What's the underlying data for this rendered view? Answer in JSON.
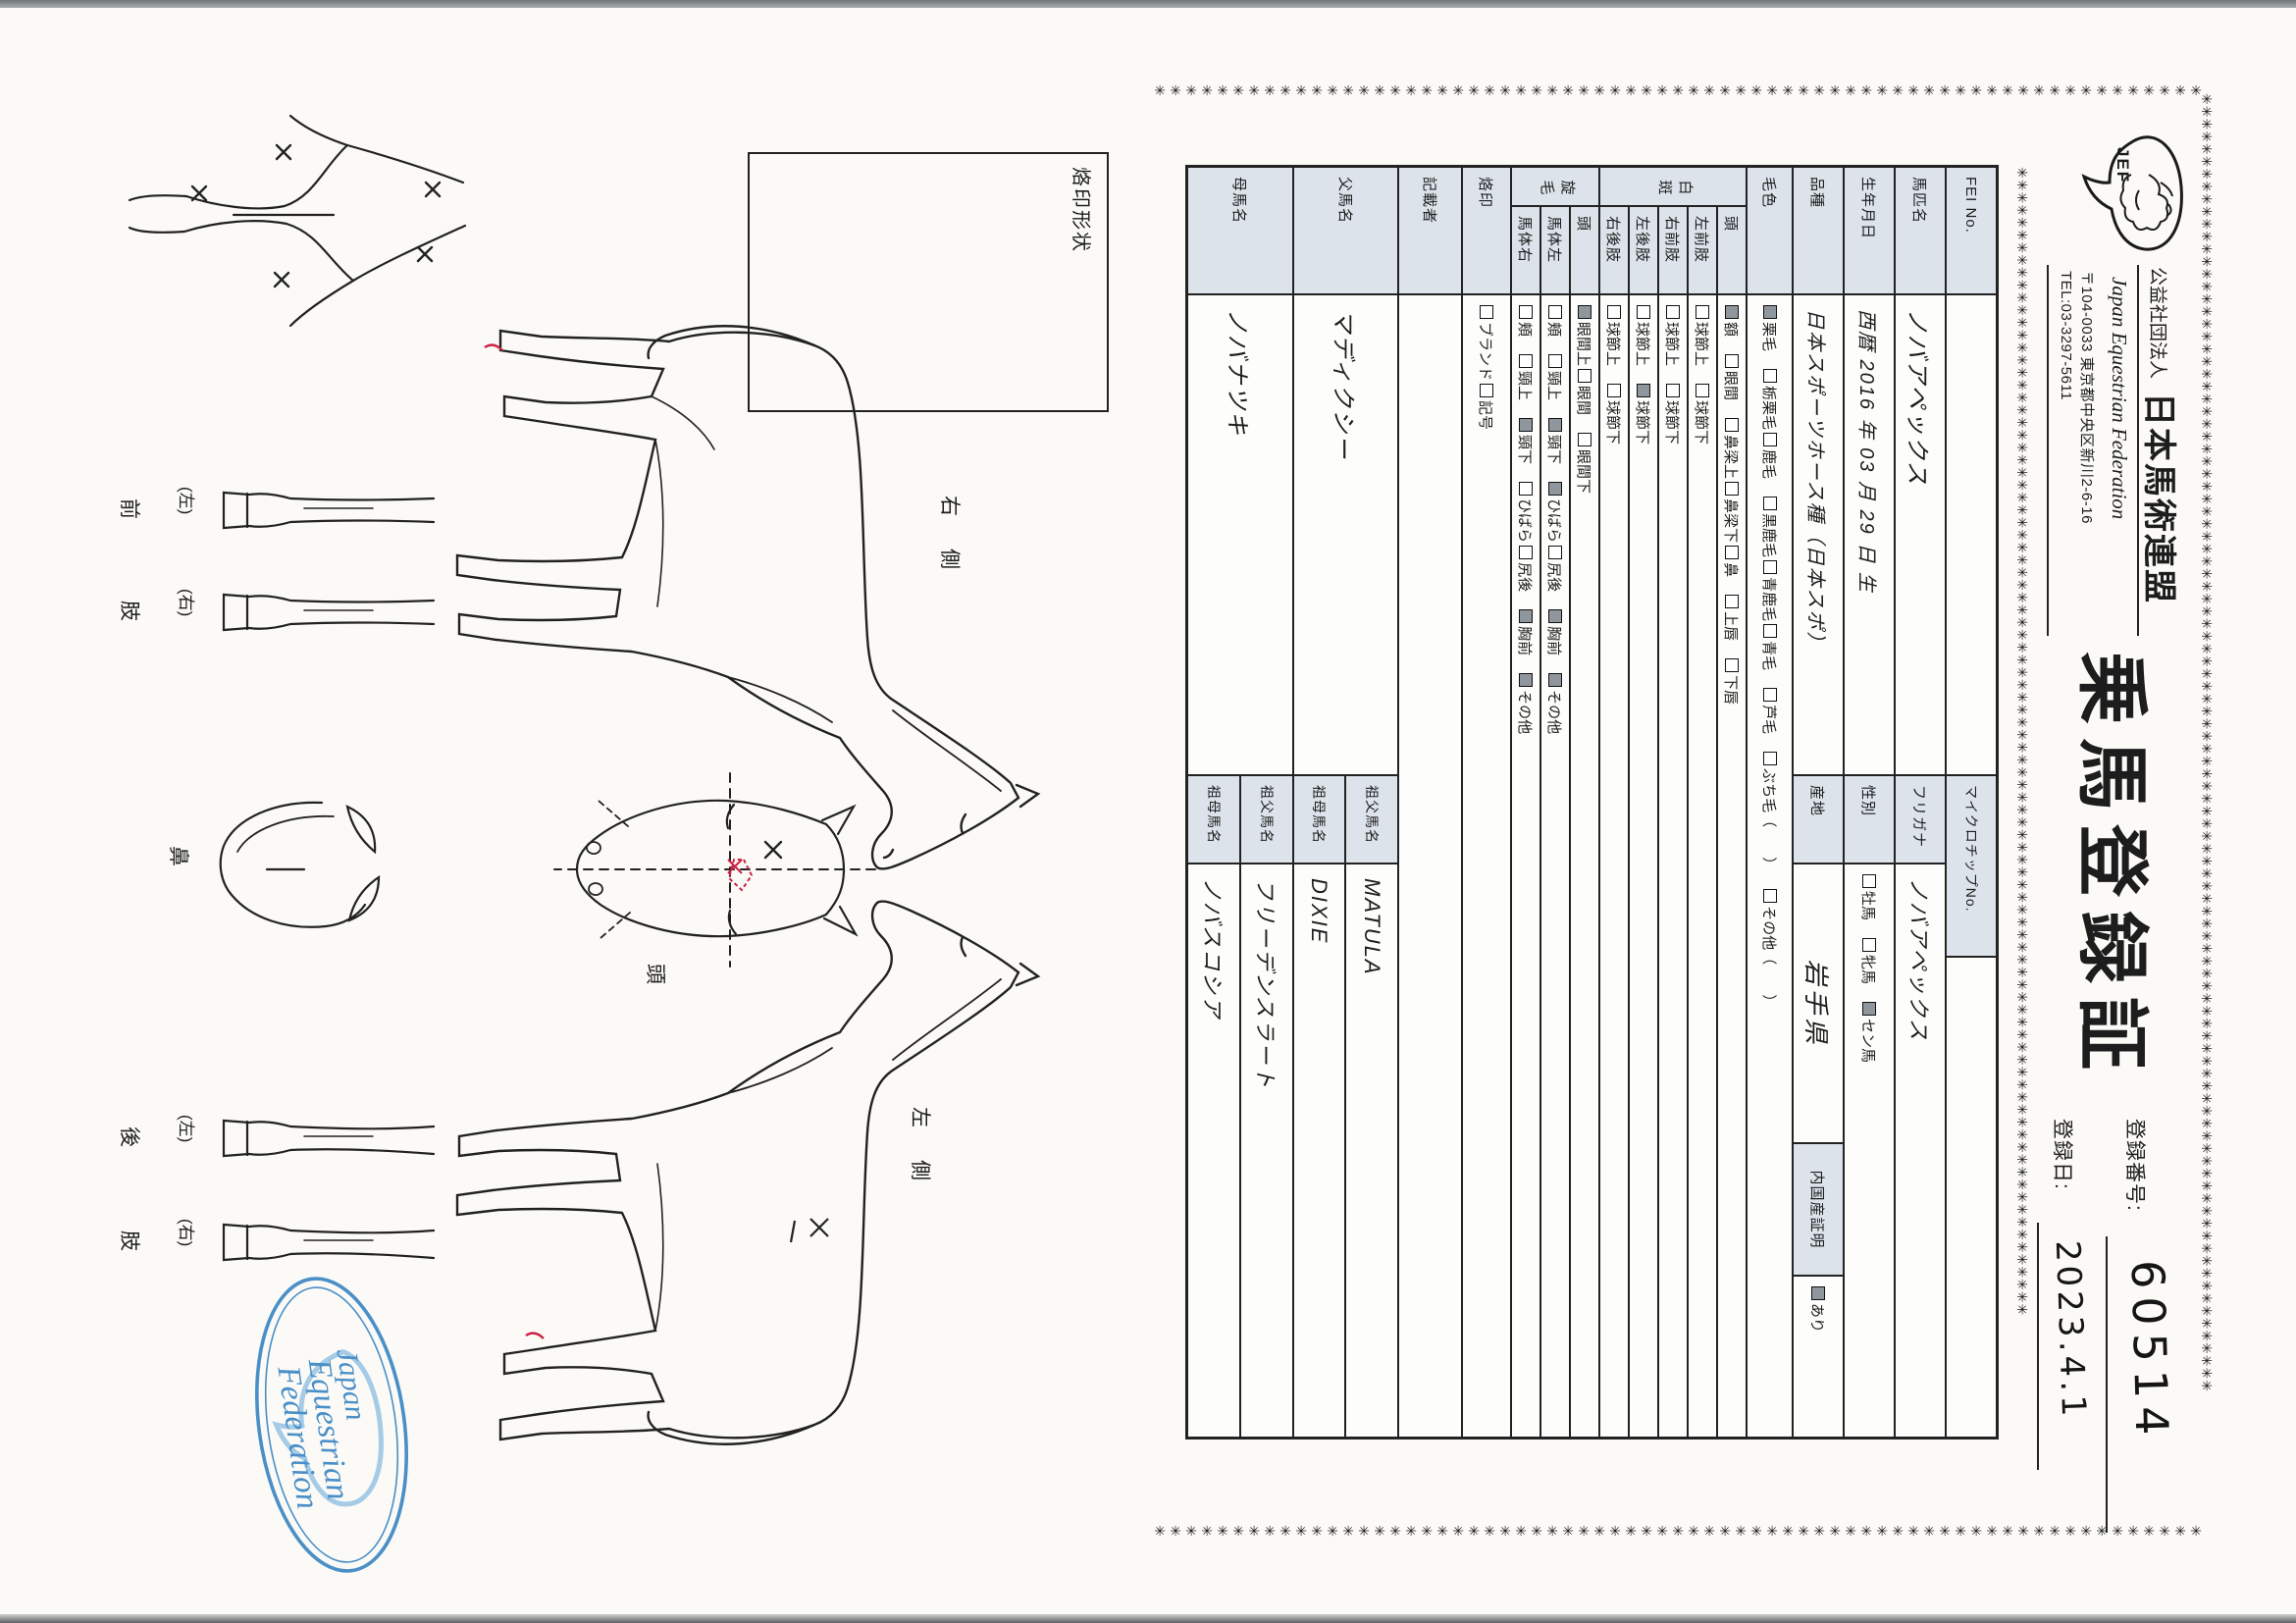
{
  "border": {
    "char": "✳"
  },
  "colors": {
    "label_cell_bg": "#dce3ea",
    "checked_box_fill": "#8f969e",
    "stamp_blue": "#4a8fc7",
    "mark_red": "#cc2244",
    "ink": "#1d1d1d"
  },
  "header": {
    "logo_text": "JEF",
    "org_type": "公益社団法人",
    "org_name": "日本馬術連盟",
    "org_name_en": "Japan Equestrian Federation",
    "address": "〒104-0033 東京都中央区新川2-6-16",
    "tel": "TEL:03-3297-5611",
    "title": "乗馬登録証",
    "reg_no_label": "登録番号:",
    "reg_no": "60514",
    "reg_date_label": "登録日:",
    "reg_date": "2023.4.1"
  },
  "table": {
    "fei_label": "FEI No.",
    "fei_value": "",
    "microchip_label": "マイクロチップNo.",
    "microchip_value": "",
    "horse_name_label": "馬匹名",
    "horse_name": "ノバアペックス",
    "furigana_label": "フリガナ",
    "furigana": "ノバアペックス",
    "birth_label": "生年月日",
    "birth": "西暦 2016 年 03 月 29 日 生",
    "sex_label": "性別",
    "sex_options": [
      {
        "label": "牡馬",
        "checked": false,
        "gap": true
      },
      {
        "label": "牝馬",
        "checked": false,
        "gap": true
      },
      {
        "label": "セン馬",
        "checked": true
      }
    ],
    "breed_label": "品種",
    "breed": "日本スポーツホース種（日本スポ）",
    "origin_label": "産地",
    "origin": "岩手県",
    "domestic_label": "内国産証明",
    "domestic_options": [
      {
        "label": "あり",
        "checked": true
      }
    ],
    "coat_label": "毛色",
    "coat_options": [
      {
        "label": "栗毛",
        "checked": true,
        "gap": true
      },
      {
        "label": "栃栗毛",
        "checked": false
      },
      {
        "label": "鹿毛",
        "checked": false,
        "gap": true
      },
      {
        "label": "黒鹿毛",
        "checked": false
      },
      {
        "label": "青鹿毛",
        "checked": false
      },
      {
        "label": "青毛",
        "checked": false,
        "gap": true
      },
      {
        "label": "芦毛",
        "checked": false,
        "gap": true
      },
      {
        "label": "ぶち毛（　　）",
        "checked": false,
        "gap": true
      },
      {
        "label": "その他（　　）",
        "checked": false
      }
    ],
    "hakuhan_label": "白斑",
    "hakuhan_rows": [
      {
        "label": "頭",
        "options": [
          {
            "label": "額",
            "checked": true,
            "gap": true
          },
          {
            "label": "眼間",
            "checked": false,
            "gap": true
          },
          {
            "label": "鼻梁上",
            "checked": false
          },
          {
            "label": "鼻梁下",
            "checked": false
          },
          {
            "label": "鼻",
            "checked": false,
            "gap": true
          },
          {
            "label": "上唇",
            "checked": false,
            "gap": true
          },
          {
            "label": "下唇",
            "checked": false
          }
        ]
      },
      {
        "label": "左前肢",
        "options": [
          {
            "label": "球節上",
            "checked": false,
            "gap": true
          },
          {
            "label": "球節下",
            "checked": false
          }
        ]
      },
      {
        "label": "右前肢",
        "options": [
          {
            "label": "球節上",
            "checked": false,
            "gap": true
          },
          {
            "label": "球節下",
            "checked": false
          }
        ]
      },
      {
        "label": "左後肢",
        "options": [
          {
            "label": "球節上",
            "checked": false,
            "gap": true
          },
          {
            "label": "球節下",
            "checked": true
          }
        ]
      },
      {
        "label": "右後肢",
        "options": [
          {
            "label": "球節上",
            "checked": false,
            "gap": true
          },
          {
            "label": "球節下",
            "checked": false
          }
        ]
      }
    ],
    "senmo_label": "旋毛",
    "senmo_rows": [
      {
        "label": "頭",
        "options": [
          {
            "label": "眼間上",
            "checked": true
          },
          {
            "label": "眼間",
            "checked": false,
            "gap": true
          },
          {
            "label": "眼間下",
            "checked": false
          }
        ]
      },
      {
        "label": "馬体左",
        "options": [
          {
            "label": "頬",
            "checked": false,
            "gap": true
          },
          {
            "label": "頸上",
            "checked": false,
            "gap": true
          },
          {
            "label": "頸下",
            "checked": true,
            "gap": true
          },
          {
            "label": "ひばら",
            "checked": true
          },
          {
            "label": "尻後",
            "checked": false,
            "gap": true
          },
          {
            "label": "胸前",
            "checked": true,
            "gap": true
          },
          {
            "label": "その他",
            "checked": true
          }
        ]
      },
      {
        "label": "馬体右",
        "options": [
          {
            "label": "頬",
            "checked": false,
            "gap": true
          },
          {
            "label": "頸上",
            "checked": false,
            "gap": true
          },
          {
            "label": "頸下",
            "checked": true,
            "gap": true
          },
          {
            "label": "ひばら",
            "checked": false
          },
          {
            "label": "尻後",
            "checked": false,
            "gap": true
          },
          {
            "label": "胸前",
            "checked": true,
            "gap": true
          },
          {
            "label": "その他",
            "checked": true
          }
        ]
      }
    ],
    "rakuin_label": "烙印",
    "rakuin_options": [
      {
        "label": "ブランド",
        "checked": false
      },
      {
        "label": "記号",
        "checked": false
      }
    ],
    "recorder_label": "記載者",
    "recorder": "",
    "sire_label": "父馬名",
    "sire": "マディクシー",
    "dam_label": "母馬名",
    "dam": "ノバナツキ",
    "grandsire_label": "祖父馬名",
    "granddam_label": "祖母馬名",
    "sire_side": {
      "grandsire": "MATULA",
      "granddam": "DIXIE"
    },
    "dam_side": {
      "grandsire": "フリーデンスラート",
      "granddam": "ノバスコシア"
    }
  },
  "diagrams": {
    "brand_box_label": "烙印形状",
    "right_side_label": "右　側",
    "left_side_label": "左　側",
    "head_label": "頭",
    "nose_label": "鼻",
    "left_paren": "(左)",
    "right_paren": "(右)",
    "front_limb_char1": "前",
    "front_limb_char2": "肢",
    "hind_limb_char1": "後",
    "hind_limb_char2": "肢"
  },
  "stamp": {
    "line1": "Japan",
    "line2": "Equestrian",
    "line3": "Federation"
  }
}
